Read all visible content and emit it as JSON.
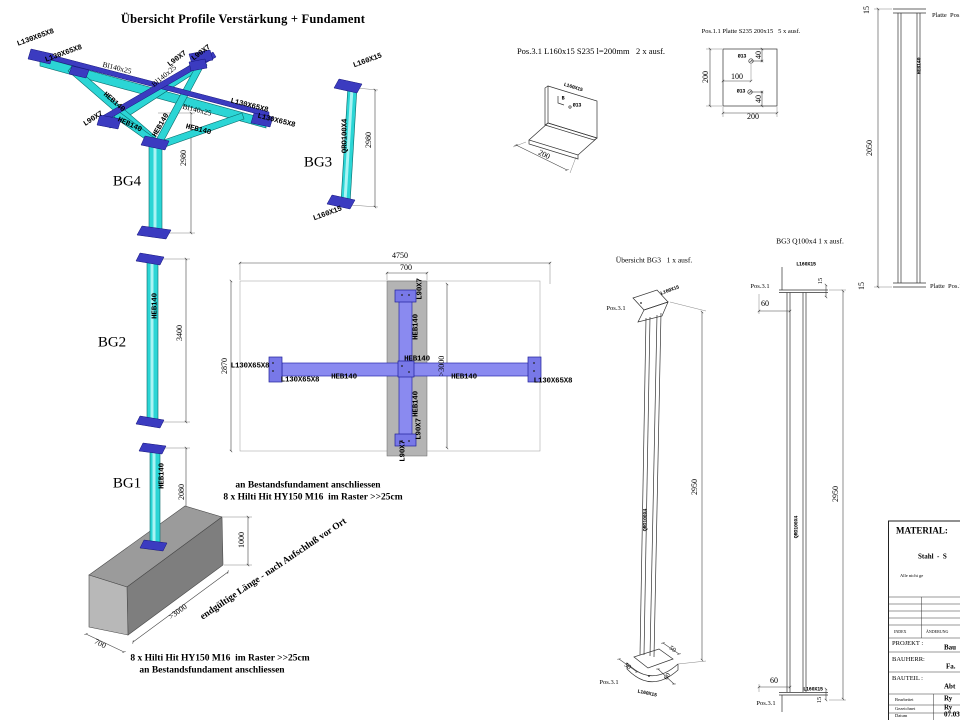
{
  "title": "Übersicht Profile Verstärkung + Fundament",
  "bg4": {
    "name": "BG4",
    "dim_height": "2980",
    "lbl_l130_a": "L130X65X8",
    "lbl_l130_b": "L130X65X8",
    "lbl_l130_c": "L130X65X8",
    "lbl_l130_d": "L130X65X8",
    "lbl_bl140_a": "Bl140x25",
    "lbl_bl140_b": "Bl140x25",
    "lbl_bl140_c": "Bl140x25",
    "lbl_l90_a": "L90X7",
    "lbl_l90_b": "L90X7",
    "lbl_l90_c": "L90X7",
    "lbl_heb_a": "HEB140",
    "lbl_heb_b": "HEB140",
    "lbl_heb_c": "HEB140",
    "lbl_heb_d": "HEB140"
  },
  "bg3": {
    "name": "BG3",
    "dim_height": "2980",
    "lbl_plate_top": "L160X15",
    "lbl_plate_bottom": "L160X15",
    "lbl_shaft": "QRO100X4"
  },
  "pos31": {
    "heading": "Pos.3.1 L160x15 S235 l=200mm   2 x ausf.",
    "lbl_angle": "L160X15",
    "lbl_b": "B",
    "lbl_hole": "Ø13",
    "dim_200": "200"
  },
  "pos11": {
    "heading": "Pos.1.1 Platte S235 200x15   5 x ausf.",
    "dim_left": "200",
    "dim_bottom": "200",
    "dim_100": "100",
    "dim_40a": "40",
    "dim_40b": "40",
    "hole_a": "Ø13",
    "hole_b": "Ø13"
  },
  "rightcol": {
    "dim_top": "15",
    "dim_mid": "2050",
    "dim_bottom": "15",
    "lbl_plate_top": "Platte  Pos.",
    "lbl_plate_bottom": "Platte  Pos.1",
    "lbl_shaft": "HEB140"
  },
  "bg3_note": "BG3 Q100x4 1 x ausf.",
  "bg2": {
    "name": "BG2",
    "dim_height": "3400",
    "lbl_shaft": "HEB140"
  },
  "plan": {
    "dim_4750": "4750",
    "dim_700": "700",
    "dim_2870": "2870",
    "dim_3000": ">3000",
    "lbl_l130_left1": "L130X65X8",
    "lbl_l130_left2": "L130X65X8",
    "lbl_l130_right": "L130X65X8",
    "lbl_heb_left": "HEB140",
    "lbl_heb_center": "HEB140",
    "lbl_heb_right": "HEB140",
    "lbl_heb_top": "HEB140",
    "lbl_heb_bottom": "HEB140",
    "lbl_l90_top": "L90X7",
    "lbl_l90_bottom": "L90X7",
    "lbl_l90_bottom2": "L90X7"
  },
  "ubg3": {
    "heading": "Übersicht BG3   1 x ausf.",
    "pos_top": "Pos.3.1",
    "pos_bottom": "Pos.3.1",
    "lbl_bracket_top": "L160X15",
    "lbl_bracket_bottom": "L160X15",
    "lbl_shaft": "QRO100X4",
    "dim_2950": "2950",
    "dim_50a": "50",
    "dim_50b": "50",
    "dim_60": "60"
  },
  "elev": {
    "pos_top": "Pos.3.1",
    "pos_bottom": "Pos.3.1",
    "lbl_bracket_top": "L160X15",
    "lbl_bracket_bottom": "L160X15",
    "lbl_shaft": "QRO100X4",
    "dim_2950": "2950",
    "dim_15_top": "15",
    "dim_60_top": "60",
    "dim_15_bottom": "15",
    "dim_60_bottom": "60"
  },
  "bg1": {
    "name": "BG1",
    "lbl_shaft": "HEB140",
    "dim_2080": "2080",
    "dim_1000": "1000",
    "dim_3000": ">3000",
    "dim_700": "700",
    "note_top1": "an Bestandsfundament anschliessen",
    "note_top2": "8 x Hilti Hit HY150 M16  im Raster >>25cm",
    "note_diag": "endgültige Länge - nach Aufschluß vor Ort",
    "note_bottom1": "8 x Hilti Hit HY150 M16  im Raster >>25cm",
    "note_bottom2": "an Bestandsfundament anschliessen"
  },
  "tb": {
    "material": "MATERIAL:",
    "material_value": "Stahl  -  S",
    "material_note": "Alle nicht ge",
    "index_label": "INDEX",
    "aenderung_label": "ÄNDERUNG",
    "projekt_label": "PROJEKT :",
    "projekt_value": "Bau",
    "bauherr_label": "BAUHERR:",
    "bauherr_value": "Fa.",
    "bauteil_label": "BAUTEIL :",
    "bauteil_value": "Abt",
    "bearbeitet_label": "Bearbeitet",
    "bearbeitet_value": "Ry",
    "gezeichnet_label": "Gezeichnet",
    "gezeichnet_value": "Ry",
    "datum_label": "Datum",
    "datum_value": "07.03.16"
  },
  "colors": {
    "cyan": "#2BD5D5",
    "blue": "#3B3BC0",
    "plan_beam": "#8A8AF0",
    "plate_gray": "#B4B4B4",
    "foundation": "#8E8E8E"
  }
}
